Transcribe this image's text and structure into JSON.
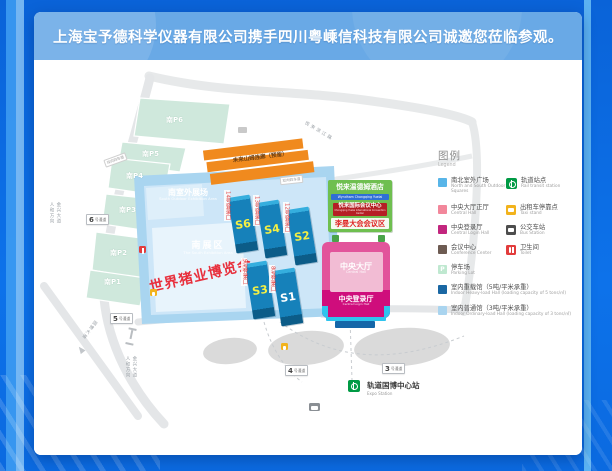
{
  "banner": {
    "text": "上海宝予德科学仪器有限公司携手四川粤嵊信科技有限公司诚邀您莅临参观。"
  },
  "colors": {
    "background_blue": "#0d72ea",
    "banner_blue": "#69a9e6",
    "hall_blue": "#1681ba",
    "outdoor_zone_blue": "#a9d5f0",
    "central_hall_pink": "#e2549b",
    "central_login_magenta": "#cf0d7c",
    "hotel_green": "#6fbf50",
    "orange_building": "#f08a1e",
    "expo_red": "#e82f3c"
  },
  "map": {
    "parking": [
      "南P6",
      "南P5",
      "南P4",
      "南P3",
      "南P2",
      "南P1"
    ],
    "channels": [
      {
        "num": "6",
        "suffix": "号通道"
      },
      {
        "num": "5",
        "suffix": "号通道"
      },
      {
        "num": "4",
        "suffix": "号通道"
      },
      {
        "num": "3",
        "suffix": "号通道"
      }
    ],
    "lane_badge": "双向四车道",
    "orange_building": {
      "zh": "未来山姆连廊（预留）"
    },
    "south_outdoor": {
      "zh": "南室外展场",
      "en": "South Outdoor Exhibition Area"
    },
    "south_zone": {
      "zh": "南展区",
      "en": "The South Exhibition Area"
    },
    "expo_title": "世界猪业博览会",
    "halls": [
      {
        "id": "S6",
        "gate": "14号登录口",
        "label_color": "#f5f043"
      },
      {
        "id": "S4",
        "gate": "13号登录口",
        "label_color": "#f5f043"
      },
      {
        "id": "S2",
        "gate": "12号登录口",
        "label_color": "#f5f043"
      },
      {
        "id": "S3",
        "gate": "9号登录口",
        "label_color": "#f5f043"
      },
      {
        "id": "S1",
        "gate": "8号登录口",
        "label_color": "#ffffff"
      }
    ],
    "hotel": {
      "zh": "悦来温德姆酒店",
      "en": "Wyndham Chongqing Yuelai"
    },
    "convention_center": {
      "zh": "悦来国际会议中心",
      "en": "Chongqing Yuelai International Convention Center"
    },
    "leman_area": "李曼大会会议区",
    "central_hall": {
      "zh": "中央大厅",
      "en": "Central Hall"
    },
    "central_login": {
      "zh": "中央登录厅",
      "en": "Central Login Hall"
    },
    "rail_station": {
      "zh": "轨道国博中心站",
      "en": "Expo Station"
    },
    "roads": {
      "jinxing": "金兴大道",
      "renhe": "人和方向",
      "guobo": "国博大道",
      "binjiang": "悦来滨江路"
    }
  },
  "legend": {
    "title_zh": "图例",
    "title_en": "Legend",
    "areas": [
      {
        "color": "#58b5e8",
        "zh": "南北室外广场",
        "en": "North and South Outdoor Squares"
      },
      {
        "color": "#f2879b",
        "zh": "中央大厅正厅",
        "en": "Central Hall"
      },
      {
        "color": "#c2267e",
        "zh": "中央登录厅",
        "en": "Central Login Hall"
      },
      {
        "color": "#6d5b52",
        "zh": "会议中心",
        "en": "Conference Center"
      },
      {
        "color": "#bfe8d0",
        "chip_label": "P",
        "zh": "停车场",
        "en": "Parking Lot"
      },
      {
        "color": "#1a67a3",
        "zh": "室内重载馆（5吨/平米承重）",
        "en": "Indoor Heavy-load Hall (loading capacity of 5 tons/㎡)"
      },
      {
        "color": "#a9d4ef",
        "zh": "室内普通馆（3吨/平米承重）",
        "en": "Indoor Ordinary-load Hall (loading capacity of 3 tons/㎡)"
      }
    ],
    "pois": [
      {
        "color": "#009a44",
        "icon": "rail-transit-icon",
        "zh": "轨道站点",
        "en": "Rail transit station"
      },
      {
        "color": "#f2b31c",
        "icon": "taxi-icon",
        "zh": "出租车停靠点",
        "en": "Taxi stand"
      },
      {
        "color": "#4d4d4d",
        "icon": "bus-icon",
        "zh": "公交车站",
        "en": "Bus Station"
      },
      {
        "color": "#e23c3c",
        "icon": "toilet-icon",
        "zh": "卫生间",
        "en": "Toilet"
      }
    ]
  }
}
